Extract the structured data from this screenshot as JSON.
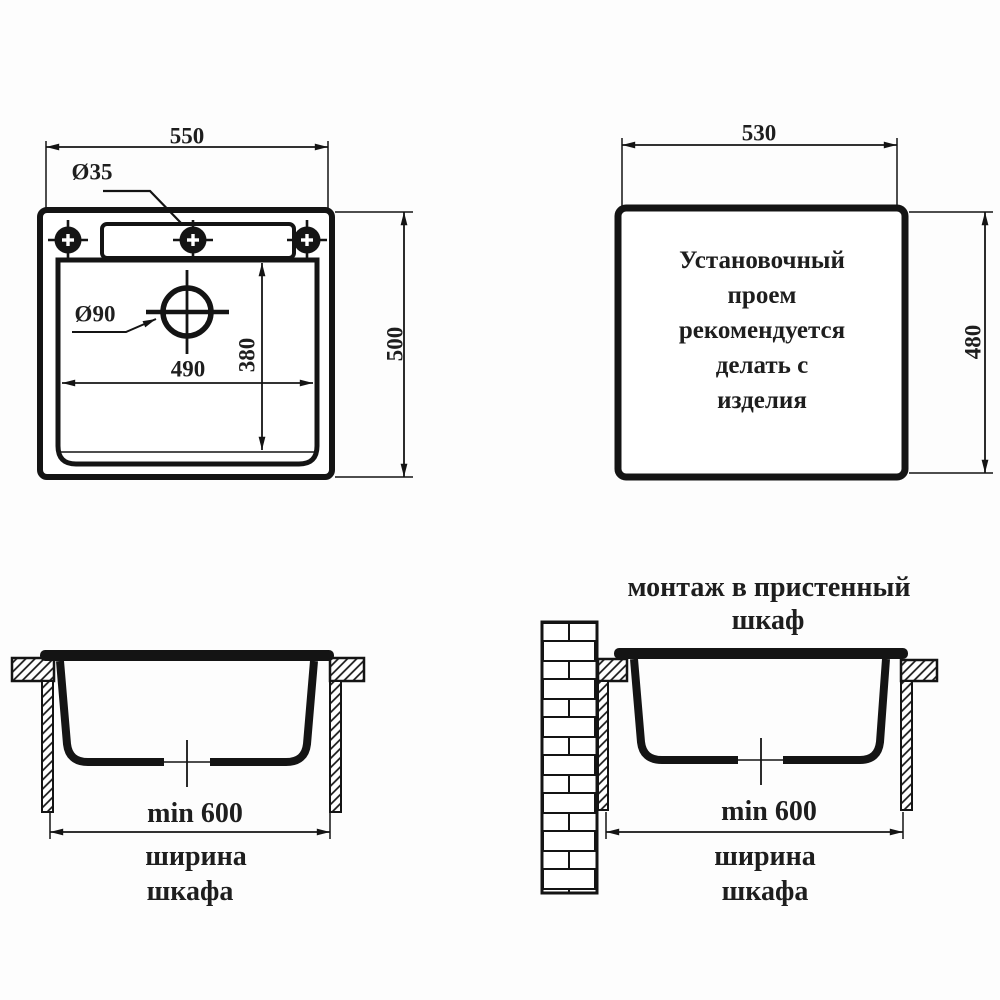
{
  "colors": {
    "line": "#141414",
    "text": "#1e1e1e",
    "bg": "#fdfdfd"
  },
  "top_view": {
    "overall_width": "550",
    "faucet_hole_dia": "Ø35",
    "drain_dia": "Ø90",
    "bowl_width": "490",
    "bowl_depth": "380",
    "overall_depth": "500"
  },
  "cutout_view": {
    "cutout_width": "530",
    "cutout_height": "480",
    "note_lines": [
      "Установочный",
      "проем",
      "рекомендуется",
      "делать с",
      "изделия"
    ]
  },
  "section_standard": {
    "min_width": "min 600",
    "caption_lines": [
      "ширина",
      "шкафа"
    ]
  },
  "section_wall": {
    "title_lines": [
      "монтаж в пристенный",
      "шкаф"
    ],
    "min_width": "min 600",
    "caption_lines": [
      "ширина",
      "шкафа"
    ]
  }
}
